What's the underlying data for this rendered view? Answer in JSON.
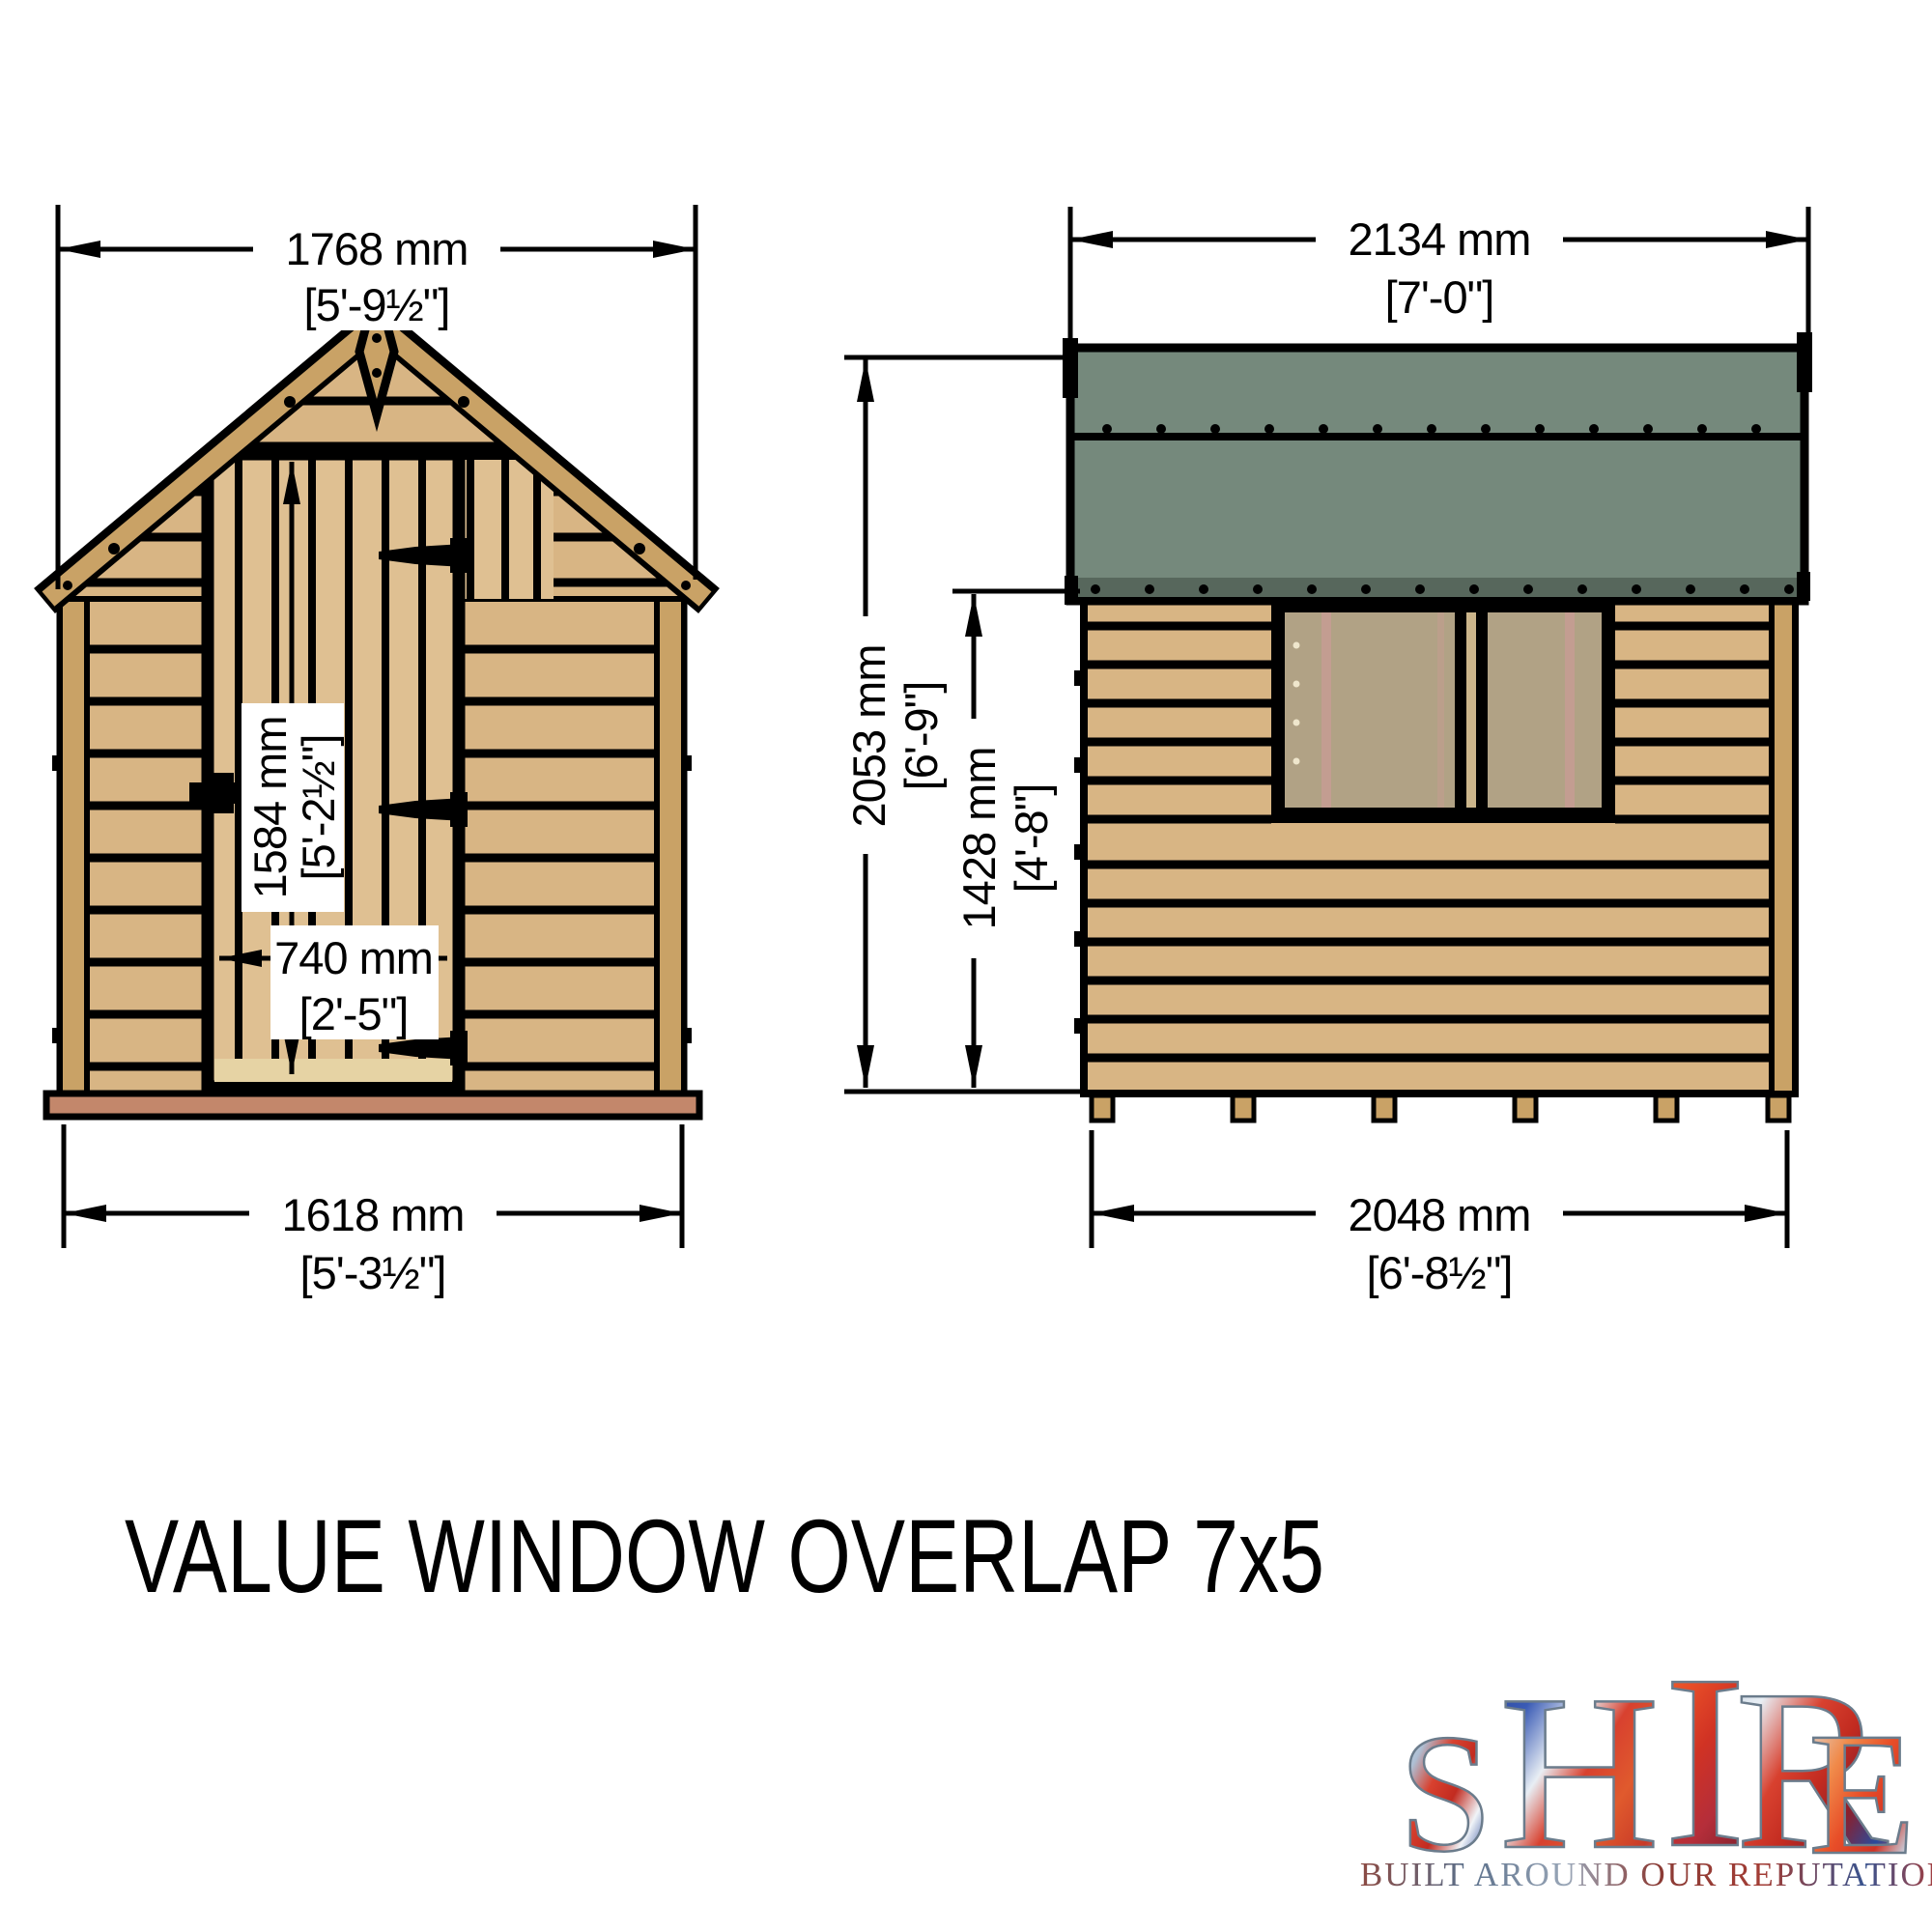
{
  "title": "VALUE WINDOW OVERLAP 7x5",
  "front_view": {
    "label": "front-elevation",
    "dim_roof_width": {
      "mm": "1768 mm",
      "imperial": "[5'-9½\"]"
    },
    "dim_door_height": {
      "mm": "1584 mm",
      "imperial": "[5'-2½\"]"
    },
    "dim_door_width": {
      "mm": "740 mm",
      "imperial": "[2'-5\"]"
    },
    "dim_base_width": {
      "mm": "1618 mm",
      "imperial": "[5'-3½\"]"
    }
  },
  "side_view": {
    "label": "side-elevation",
    "dim_roof_width": {
      "mm": "2134 mm",
      "imperial": "[7'-0\"]"
    },
    "dim_total_height": {
      "mm": "2053 mm",
      "imperial": "[6'-9\"]"
    },
    "dim_wall_height": {
      "mm": "1428 mm",
      "imperial": "[4'-8\"]"
    },
    "dim_base_width": {
      "mm": "2048 mm",
      "imperial": "[6'-8½\"]"
    }
  },
  "logo": {
    "brand": "SHIRE",
    "brand_letters": [
      "S",
      "H",
      "I",
      "R",
      "E"
    ],
    "tagline": "BUILT AROUND OUR REPUTATION"
  },
  "colors": {
    "wood": "#d8b584",
    "wood_light": "#dfc092",
    "trim": "#c9a266",
    "roof_felt": "#75897c",
    "roof_felt_dark": "#57675c",
    "floor_strip": "#c3876b",
    "window_glazing": "#b1a285",
    "outline": "#000000"
  }
}
